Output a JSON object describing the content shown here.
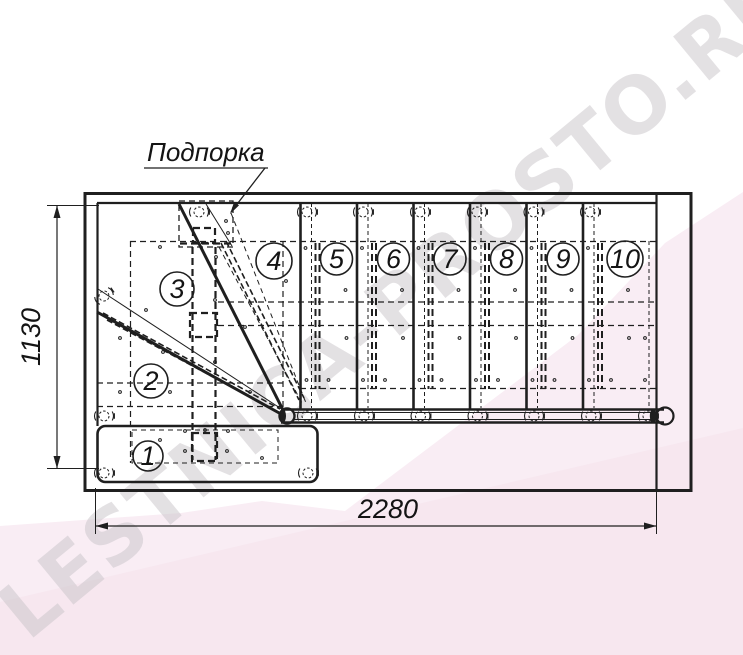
{
  "watermark": {
    "text": "LESTNICA-PROSTO.RU"
  },
  "drawing": {
    "support_label": "Подпорка",
    "step_numbers": [
      "1",
      "2",
      "3",
      "4",
      "5",
      "6",
      "7",
      "8",
      "9",
      "10"
    ],
    "dimension_width": "2280",
    "dimension_height": "1130"
  },
  "colors": {
    "line": "#1f1f1f",
    "background": "#ffffff",
    "pink_light": "#f9edf4",
    "pink_deep": "#f5e4ee",
    "watermark": "#c9c4c9"
  }
}
